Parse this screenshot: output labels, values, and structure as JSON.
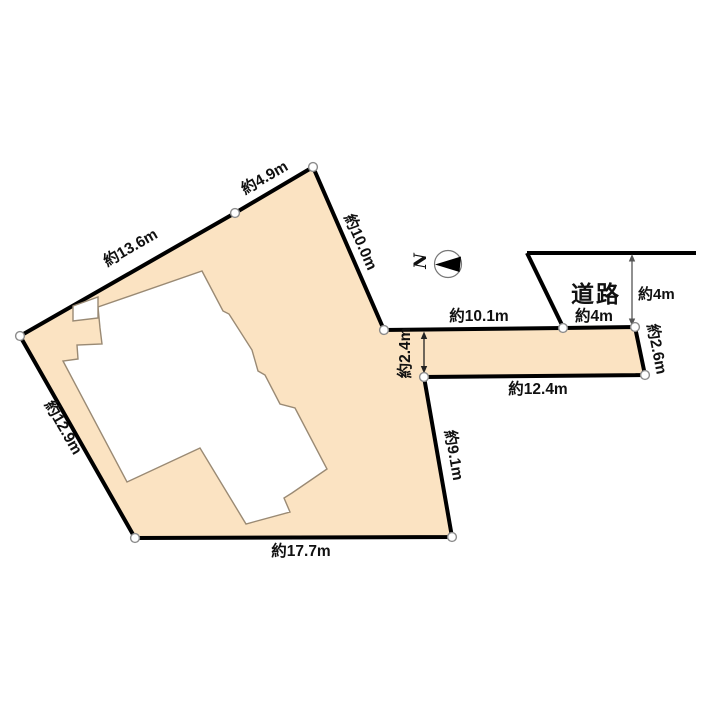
{
  "diagram_type": "land-plot-survey",
  "labels": {
    "edge_ab": "約13.6m",
    "edge_bc": "約4.9m",
    "edge_cd": "約10.0m",
    "edge_de": "約10.1m",
    "edge_ef": "約4m",
    "edge_fg": "約2.6m",
    "edge_gh": "約12.4m",
    "edge_hi": "約9.1m",
    "edge_ij": "約17.7m",
    "edge_ja": "約12.9m",
    "strip_width": "約2.4m",
    "road_width": "約4m",
    "road": "道路",
    "north": "N"
  },
  "colors": {
    "plot_fill": "#fbe3c2",
    "boundary": "#000000",
    "building_fill": "#ffffff",
    "building_outline": "#9a8a74",
    "marker_fill": "#ffffff",
    "marker_stroke": "#8b8b8b",
    "dimension_arrow": "#444444",
    "text": "#111111"
  }
}
